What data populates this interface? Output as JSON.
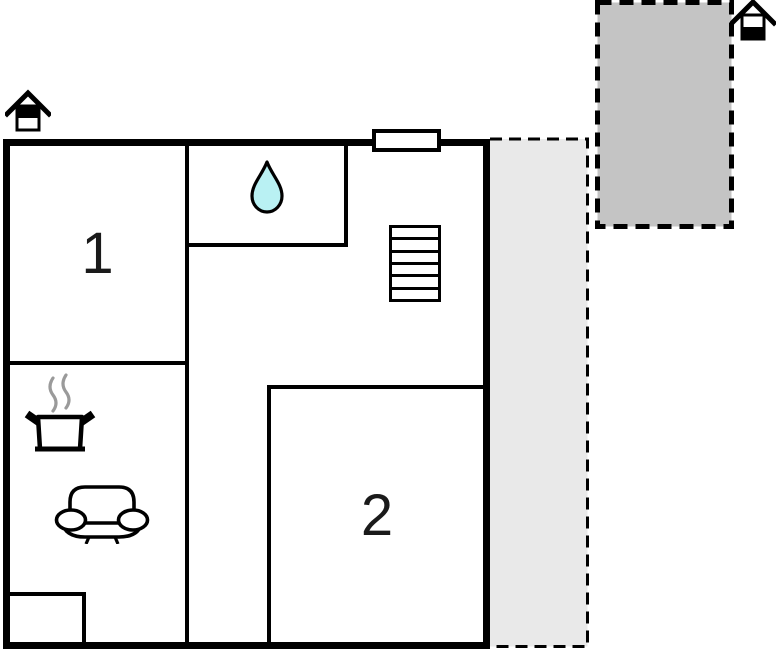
{
  "title": "Holiday home floor plan",
  "plan": {
    "rooms": [
      {
        "id": "room-1",
        "label": "1",
        "feature": "bedroom"
      },
      {
        "id": "room-2",
        "label": "2",
        "feature": "bedroom"
      }
    ],
    "features": [
      "bathroom-with-water-drop",
      "staircase-6-treads",
      "kitchen-cooking-pot",
      "living-room-sofa",
      "wall-window-marker",
      "terrace-strip-dashed",
      "patio-dashed",
      "closet-nook"
    ],
    "icons": {
      "house_upper": "house-level-icon-upper-shaded",
      "house_lower": "house-level-icon-lower-shaded",
      "drop": "water-drop-icon",
      "pot": "cooking-pot-icon",
      "steam": "steam-icon",
      "sofa": "sofa-icon",
      "stairs": "stairs-icon",
      "window": "window-marker"
    }
  },
  "colors": {
    "wall": "#000000",
    "terrace-light": "#e9e9e9",
    "terrace-dark": "#c4c4c4",
    "water-drop": "#b9f1f3",
    "steam": "#9a9a9a",
    "page-bg": "#ffffff",
    "label-color": "#1a1a1a"
  }
}
